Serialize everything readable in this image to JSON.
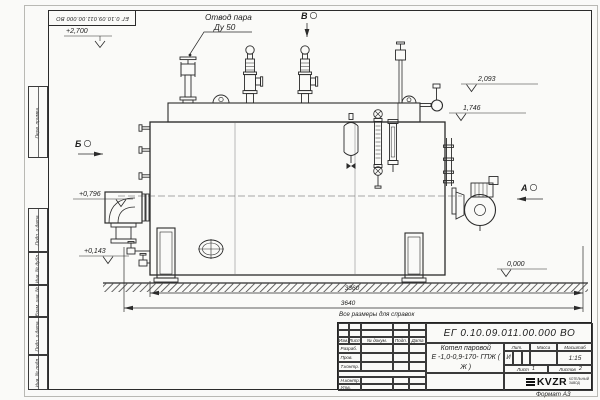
{
  "sheet": {
    "stamp_rotated": "ЕГ 0.10.09.011.00.000  ВО",
    "format_label": "Формат А3",
    "reference_note": "Все размеры для справок"
  },
  "margin_labels": [
    "Перв. примен.",
    "Подп. и дата",
    "Инв. № дубл.",
    "Взам. инв. №",
    "Подп. и дата",
    "Инв. № подл."
  ],
  "callouts": {
    "steam_outlet_line1": "Отвод пара",
    "steam_outlet_line2": "Ду 50"
  },
  "view_markers": {
    "a": "А",
    "b": "Б",
    "v": "В"
  },
  "elevations": {
    "top": "+2,700",
    "upper": "2,093",
    "flue": "1,746",
    "mid": "+0,796",
    "low": "+0,143",
    "ground": "0,000"
  },
  "dimensions": {
    "inner_length": "3360",
    "overall_length": "3640"
  },
  "title_block": {
    "doc_number": "ЕГ 0.10.09.011.00.000  ВО",
    "product_line1": "Котел паровой",
    "product_line2": "Е -1,0-0,9-170- ГПЖ ( Ж )",
    "col_izm": "Изм.",
    "col_list": "Лист",
    "col_doc": "№ докум.",
    "col_podp": "Подп.",
    "col_data": "Дата",
    "row_developed": "Разраб.",
    "row_checked": "Пров.",
    "row_tcontrol": "Т.контр.",
    "row_ncontrol": "Н.контр.",
    "row_approved": "Утв.",
    "lit_header": "Лит.",
    "mass_header": "Масса",
    "scale_header": "Масштаб",
    "lit_value": "И",
    "scale_value": "1:15",
    "sheet_label": "Лист",
    "sheet_number": "1",
    "sheets_label": "Листов",
    "sheets_total": "2",
    "logo_text": "KVZR",
    "logo_sub_line1": "КОТЕЛЬНЫЙ",
    "logo_sub_line2": "ЗАВОД"
  }
}
